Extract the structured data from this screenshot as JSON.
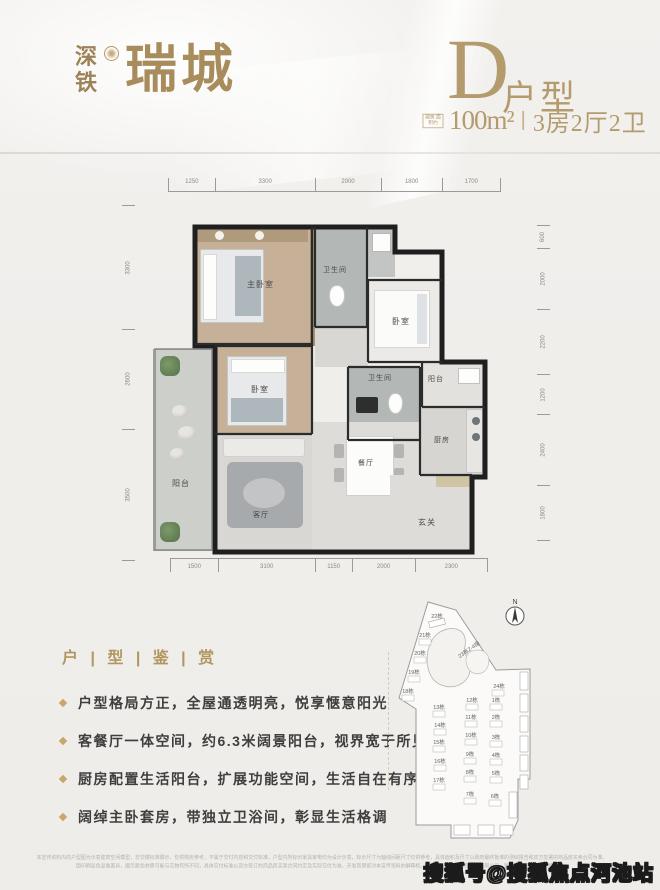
{
  "colors": {
    "accent_gold": "#b2965f",
    "logo_gold": "#a88c5c",
    "wall_black": "#1f1f1f",
    "background": "#f1efec"
  },
  "header": {
    "logo": {
      "char1": "深",
      "char2": "铁",
      "brand": "瑞城"
    },
    "unit": {
      "letter": "D",
      "unit_word": "户型",
      "area_note": "建筑 面积约",
      "area_value": "100m²",
      "separator": "|",
      "spec": "3房2厅2卫"
    }
  },
  "floorplan": {
    "dims_top": [
      "1250",
      "3300",
      "2000",
      "1800",
      "1700"
    ],
    "dims_bottom": [
      "1500",
      "3100",
      "1150",
      "2000",
      "2300"
    ],
    "dims_left": [
      "3300",
      "2600",
      "3500"
    ],
    "dims_right": [
      "600",
      "2000",
      "2200",
      "1200",
      "2400",
      "1800"
    ],
    "rooms": [
      {
        "label": "主卧室"
      },
      {
        "label": "卫生间"
      },
      {
        "label": "卧室"
      },
      {
        "label": "卧室"
      },
      {
        "label": "卫生间"
      },
      {
        "label": "阳台"
      },
      {
        "label": "厨房"
      },
      {
        "label": "餐厅"
      },
      {
        "label": "客厅"
      },
      {
        "label": "阳台"
      },
      {
        "label": "玄关"
      }
    ]
  },
  "features": {
    "heading": "户 | 型 | 鉴 | 赏",
    "bullets": [
      "户型格局方正，全屋通透明亮，悦享惬意阳光",
      "客餐厅一体空间，约6.3米阔景阳台，视界宽于所见",
      "厨房配置生活阳台，扩展功能空间，生活自在有序",
      "阔绰主卧套房，带独立卫浴间，彰显生活格调"
    ]
  },
  "siteplan": {
    "north_label": "N",
    "buildings": [
      "22栋",
      "21栋",
      "20栋",
      "19栋",
      "18栋",
      "23栋2-4座",
      "24栋",
      "13栋",
      "14栋",
      "15栋",
      "16栋",
      "17栋",
      "12栋",
      "11栋",
      "10栋",
      "9栋",
      "8栋",
      "7栋",
      "1栋",
      "2栋",
      "3栋",
      "4栋",
      "5栋",
      "6栋"
    ]
  },
  "footer": {
    "disclaimer_line1": "本宣传资料内的户型图为示意建筑空间模型，非交楼标准展示，仅供购房参考，不属于交付内容和交付标准，户型内所标示家具家电均为设计示意，标示尺寸为轴线间距尺寸仅供参考，具体面积及尺寸以政府最终批准的测绘报告和双方签署的商品房买卖合同为准。",
    "disclaimer_line2": "因印刷显色显像差异，图示颜色材质可能与实物有所不同，具体交付标准以双方签订的商品房买卖合同约定及实际交付为准。开发商保留对本宣传资料的解释权。开发商：深圳市地铁集团有限公司，销售代理机构详见现场公示。",
    "watermark": "搜狐号@搜狐焦点河池站"
  }
}
